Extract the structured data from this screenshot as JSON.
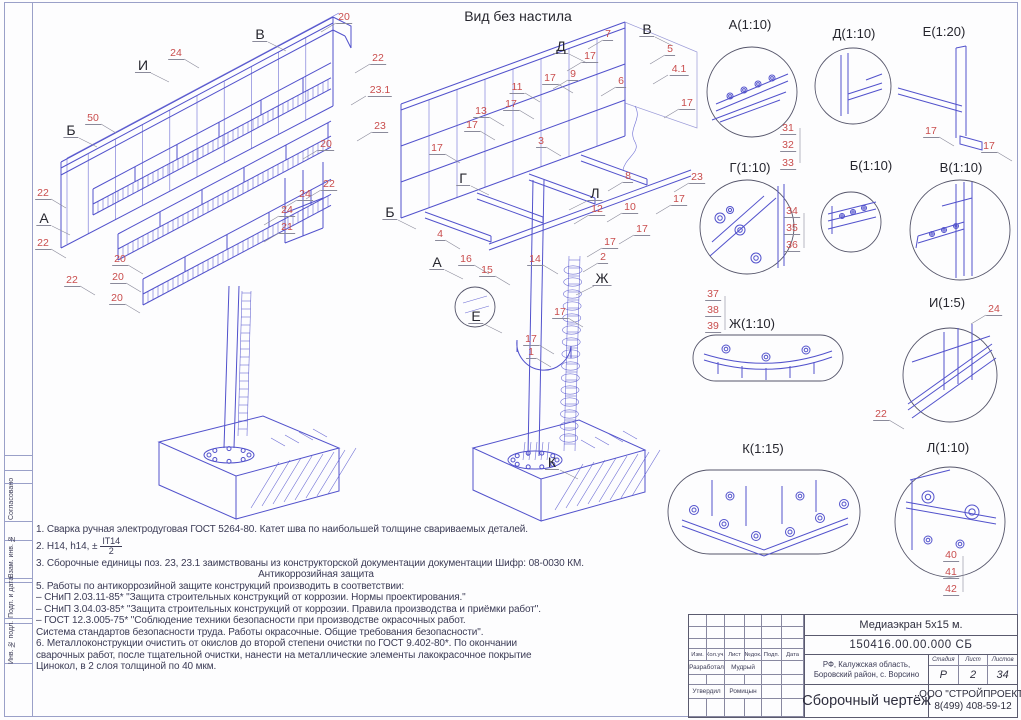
{
  "sheet": {
    "view_no_deck_title": "Вид без настила",
    "frame_sidebar": [
      "Согласовано",
      "Взам. инв. №",
      "Подп. и дата",
      "Инв. № подл."
    ]
  },
  "notes": {
    "line1": "1. Сварка ручная электродуговая ГОСТ 5264-80. Катет шва по наибольшей толщине свариваемых деталей.",
    "line2_prefix": "2. Н14, h14, ±",
    "line2_frac_top": "IT14",
    "line2_frac_bottom": "2",
    "line3": "3. Сборочные единицы поз. 23, 23.1 заимствованы из конструкторской документации документации Шифр: 08-0030 КМ.",
    "line4_heading": "Антикоррозийная защита",
    "line5": "5. Работы по антикоррозийной защите конструкций производить в соответствии:",
    "line6": "– СНиП 2.03.11-85* \"Защита строительных конструкций от коррозии. Нормы проектирования.\"",
    "line7": "– СНиП 3.04.03-85* \"Защита строительных конструкций от коррозии. Правила производства и приёмки работ\".",
    "line8": "– ГОСТ 12.3.005-75* \"Соблюдение техники безопасности при производстве окрасочных работ.",
    "line9": "Система стандартов безопасности труда. Работы окрасочные. Общие требования безопасности\".",
    "line10": "6. Металлоконструкции очистить от окислов до второй степени очистки по ГОСТ 9.402-80*. По окончании",
    "line11": "сварочных работ, после тщательной очистки, нанести на металлические элементы лакокрасочное покрытие",
    "line12": "Цинокол, в 2 слоя толщиной по 40 мкм."
  },
  "title_block": {
    "project": "Медиаэкран 5х15 м.",
    "document": "150416.00.00.000 СБ",
    "location1": "РФ, Калужская область,",
    "location2": "Боровский район, с. Ворсино",
    "stage_label": "Стадия",
    "stage": "Р",
    "sheet_label": "Лист",
    "sheet": "2",
    "sheets_label": "Листов",
    "sheets": "34",
    "doc_type": "Сборочный чертёж",
    "company": "ООО \"СТРОЙПРОЕКТ\"",
    "phone": "8(499) 408-59-12",
    "header_cols": [
      "Изм.",
      "Кол.уч.",
      "Лист",
      "№док.",
      "Подп.",
      "Дата"
    ],
    "roles": [
      {
        "role": "Разработал",
        "name": "Мудрый"
      },
      {
        "role": "Утвердил",
        "name": "Ромицын"
      }
    ]
  },
  "detail_labels": [
    {
      "t": "А(1:10)",
      "x": 750,
      "y": 17
    },
    {
      "t": "Д(1:10)",
      "x": 854,
      "y": 26
    },
    {
      "t": "Е(1:20)",
      "x": 944,
      "y": 24
    },
    {
      "t": "Г(1:10)",
      "x": 750,
      "y": 160
    },
    {
      "t": "Б(1:10)",
      "x": 871,
      "y": 158
    },
    {
      "t": "В(1:10)",
      "x": 961,
      "y": 160
    },
    {
      "t": "Ж(1:10)",
      "x": 752,
      "y": 316
    },
    {
      "t": "И(1:5)",
      "x": 947,
      "y": 295
    },
    {
      "t": "К(1:15)",
      "x": 763,
      "y": 441
    },
    {
      "t": "Л(1:10)",
      "x": 948,
      "y": 440
    }
  ],
  "view_letters": [
    {
      "t": "В",
      "x": 260,
      "y": 27,
      "s": "l"
    },
    {
      "t": "И",
      "x": 143,
      "y": 58,
      "s": "l"
    },
    {
      "t": "Б",
      "x": 71,
      "y": 123,
      "s": "l"
    },
    {
      "t": "А",
      "x": 44,
      "y": 211,
      "s": "l"
    },
    {
      "t": "Д",
      "x": 561,
      "y": 39,
      "s": "l"
    },
    {
      "t": "В",
      "x": 647,
      "y": 22,
      "s": "l"
    },
    {
      "t": "Б",
      "x": 390,
      "y": 205,
      "s": "l"
    },
    {
      "t": "Г",
      "x": 463,
      "y": 171,
      "s": "l"
    },
    {
      "t": "А",
      "x": 437,
      "y": 255,
      "s": "l"
    },
    {
      "t": "Е",
      "x": 476,
      "y": 309,
      "s": "l"
    },
    {
      "t": "Ж",
      "x": 602,
      "y": 271,
      "s": "r"
    },
    {
      "t": "Л",
      "x": 595,
      "y": 186,
      "s": "r"
    },
    {
      "t": "К",
      "x": 552,
      "y": 455,
      "s": "l"
    }
  ],
  "part_callouts": [
    {
      "t": "20",
      "x": 344,
      "y": 12,
      "s": "r"
    },
    {
      "t": "22",
      "x": 378,
      "y": 53,
      "s": "r"
    },
    {
      "t": "23.1",
      "x": 380,
      "y": 85,
      "s": "r"
    },
    {
      "t": "23",
      "x": 380,
      "y": 121,
      "s": "r"
    },
    {
      "t": "20",
      "x": 326,
      "y": 139,
      "s": "r"
    },
    {
      "t": "22",
      "x": 329,
      "y": 179,
      "s": "r"
    },
    {
      "t": "24",
      "x": 305,
      "y": 189,
      "s": "r"
    },
    {
      "t": "24",
      "x": 287,
      "y": 205,
      "s": "r"
    },
    {
      "t": "21",
      "x": 287,
      "y": 222,
      "s": "r"
    },
    {
      "t": "50",
      "x": 93,
      "y": 113,
      "s": "l"
    },
    {
      "t": "24",
      "x": 176,
      "y": 48,
      "s": "l"
    },
    {
      "t": "22",
      "x": 43,
      "y": 188,
      "s": "l"
    },
    {
      "t": "22",
      "x": 43,
      "y": 238,
      "s": "l"
    },
    {
      "t": "22",
      "x": 72,
      "y": 275,
      "s": "l"
    },
    {
      "t": "20",
      "x": 120,
      "y": 254,
      "s": "l"
    },
    {
      "t": "20",
      "x": 118,
      "y": 272,
      "s": "l"
    },
    {
      "t": "20",
      "x": 117,
      "y": 293,
      "s": "l"
    },
    {
      "t": "7",
      "x": 608,
      "y": 29,
      "s": "r"
    },
    {
      "t": "17",
      "x": 590,
      "y": 51,
      "s": "r"
    },
    {
      "t": "9",
      "x": 573,
      "y": 69,
      "s": "r"
    },
    {
      "t": "17",
      "x": 550,
      "y": 73,
      "s": "l"
    },
    {
      "t": "11",
      "x": 517,
      "y": 82,
      "s": "l"
    },
    {
      "t": "17",
      "x": 511,
      "y": 99,
      "s": "l"
    },
    {
      "t": "13",
      "x": 481,
      "y": 106,
      "s": "l"
    },
    {
      "t": "17",
      "x": 472,
      "y": 120,
      "s": "l"
    },
    {
      "t": "17",
      "x": 437,
      "y": 143,
      "s": "l"
    },
    {
      "t": "3",
      "x": 541,
      "y": 136,
      "s": "l"
    },
    {
      "t": "5",
      "x": 670,
      "y": 44,
      "s": "r"
    },
    {
      "t": "4.1",
      "x": 679,
      "y": 64,
      "s": "r"
    },
    {
      "t": "6",
      "x": 621,
      "y": 76,
      "s": "r"
    },
    {
      "t": "17",
      "x": 687,
      "y": 98,
      "s": "r"
    },
    {
      "t": "8",
      "x": 628,
      "y": 171,
      "s": "r"
    },
    {
      "t": "10",
      "x": 630,
      "y": 202,
      "s": "r"
    },
    {
      "t": "12",
      "x": 597,
      "y": 204,
      "s": "r"
    },
    {
      "t": "17",
      "x": 679,
      "y": 194,
      "s": "r"
    },
    {
      "t": "17",
      "x": 642,
      "y": 224,
      "s": "r"
    },
    {
      "t": "17",
      "x": 610,
      "y": 237,
      "s": "r"
    },
    {
      "t": "2",
      "x": 603,
      "y": 252,
      "s": "r"
    },
    {
      "t": "4",
      "x": 440,
      "y": 229,
      "s": "l"
    },
    {
      "t": "16",
      "x": 466,
      "y": 254,
      "s": "l"
    },
    {
      "t": "15",
      "x": 487,
      "y": 265,
      "s": "l"
    },
    {
      "t": "14",
      "x": 535,
      "y": 254,
      "s": "l"
    },
    {
      "t": "17",
      "x": 560,
      "y": 307,
      "s": "l"
    },
    {
      "t": "17",
      "x": 531,
      "y": 334,
      "s": "l"
    },
    {
      "t": "1",
      "x": 531,
      "y": 347,
      "s": "l"
    },
    {
      "t": "23",
      "x": 697,
      "y": 172,
      "s": "r"
    },
    {
      "t": "31",
      "x": 788,
      "y": 123,
      "s": "n"
    },
    {
      "t": "32",
      "x": 788,
      "y": 140,
      "s": "n"
    },
    {
      "t": "33",
      "x": 788,
      "y": 158,
      "s": "n"
    },
    {
      "t": "34",
      "x": 792,
      "y": 206,
      "s": "n"
    },
    {
      "t": "35",
      "x": 792,
      "y": 223,
      "s": "n"
    },
    {
      "t": "36",
      "x": 792,
      "y": 240,
      "s": "n"
    },
    {
      "t": "37",
      "x": 713,
      "y": 289,
      "s": "n"
    },
    {
      "t": "38",
      "x": 713,
      "y": 305,
      "s": "n"
    },
    {
      "t": "39",
      "x": 713,
      "y": 321,
      "s": "n"
    },
    {
      "t": "17",
      "x": 931,
      "y": 126,
      "s": "l"
    },
    {
      "t": "17",
      "x": 989,
      "y": 141,
      "s": "l"
    },
    {
      "t": "24",
      "x": 994,
      "y": 304,
      "s": "r"
    },
    {
      "t": "22",
      "x": 881,
      "y": 409,
      "s": "l"
    },
    {
      "t": "40",
      "x": 951,
      "y": 550,
      "s": "n"
    },
    {
      "t": "41",
      "x": 951,
      "y": 567,
      "s": "n"
    },
    {
      "t": "42",
      "x": 951,
      "y": 584,
      "s": "n"
    }
  ],
  "colors": {
    "line_blue": "#5252cc",
    "callout_red": "#c94d4d",
    "frame_blue": "#9aa0c8",
    "text_dark": "#2e2e3e"
  }
}
